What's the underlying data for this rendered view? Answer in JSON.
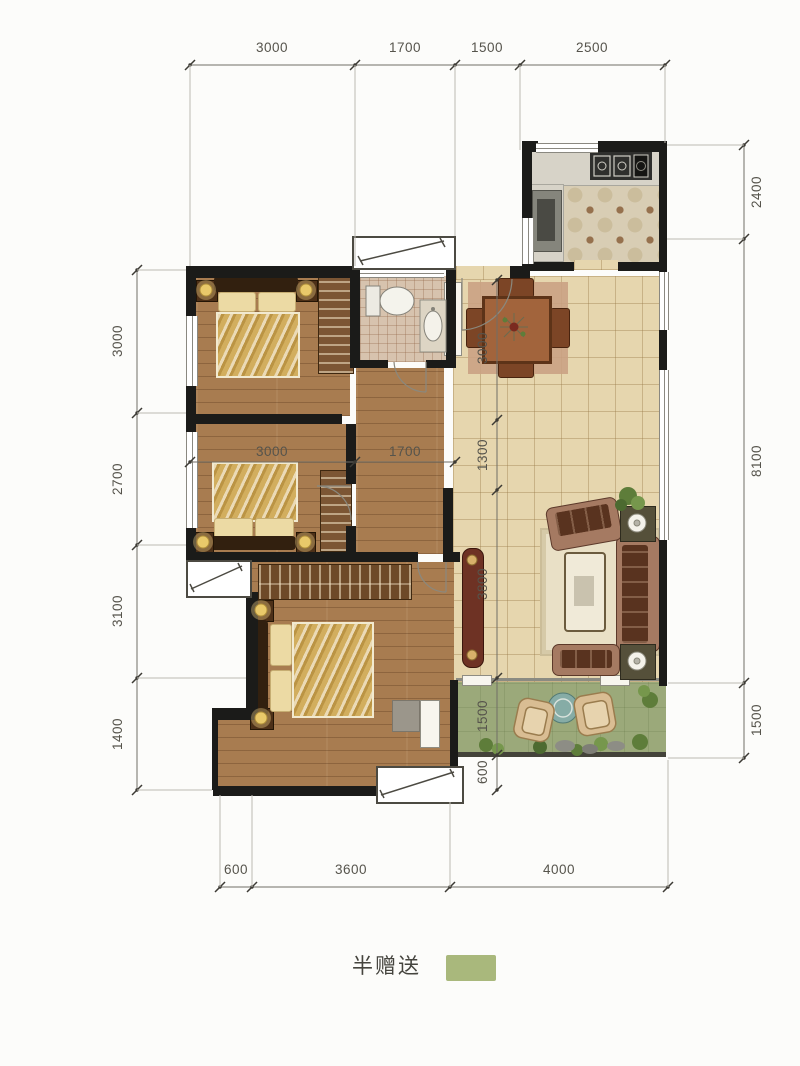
{
  "legend": {
    "label": "半赠送",
    "swatch_color": "#a9b87c"
  },
  "dimensions": {
    "top": [
      "3000",
      "1700",
      "1500",
      "2500"
    ],
    "left": [
      "3000",
      "2700",
      "3100",
      "1400"
    ],
    "right": [
      "2400",
      "8100",
      "1500"
    ],
    "bottom": [
      "600",
      "3600",
      "4000"
    ],
    "inner_horizontal": [
      "3000",
      "1700"
    ],
    "inner_vertical": [
      "3000",
      "1300",
      "3800",
      "1500",
      "600"
    ]
  },
  "colors": {
    "wall": "#1b1b19",
    "wood_floor": "#a87c50",
    "tile_floor": "#e6d6ae",
    "kitchen_tile": "#d8cdb4",
    "bath_tile": "#d7c3ae",
    "balcony_green": "#9ba97a",
    "bedding_gold": "#d2ae5e",
    "sofa": "#a57a62",
    "legend_green": "#a9b87c"
  }
}
